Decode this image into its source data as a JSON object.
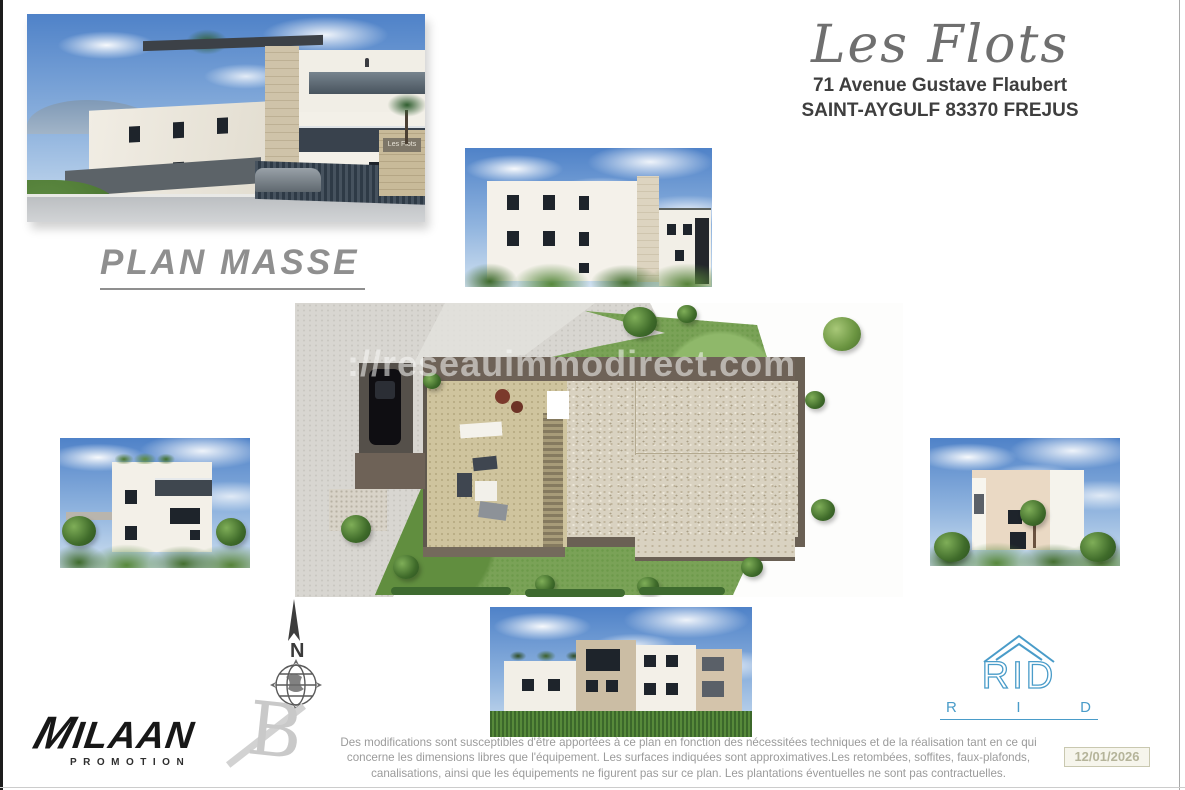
{
  "header": {
    "title": "Les Flots",
    "address_line1": "71 Avenue Gustave Flaubert",
    "address_line2": "SAINT-AYGULF 83370 FREJUS"
  },
  "plan_label": "PLAN MASSE",
  "site_plan": {
    "watermark": "://reseauimmodirect.com"
  },
  "compass": {
    "north_label": "N"
  },
  "logos": {
    "milaan": {
      "m": "M",
      "name": "ILAAN",
      "subtitle": "PROMOTION"
    },
    "architect": {
      "letter": "B"
    },
    "rid": {
      "house_letters": "RID",
      "r": "R",
      "i": "I",
      "d": "D"
    }
  },
  "entrance_sign": "Les Flots",
  "disclaimer": {
    "text": "Des modifications sont susceptibles d'être apportées à ce plan en fonction des nécessitées techniques et de la réalisation tant en ce qui concerne les dimensions libres que l'équipement.  Les surfaces indiquées sont approximatives.Les retombées, soffites, faux-plafonds, canalisations, ainsi que les équipements ne figurent pas sur ce plan. Les plantations éventuelles ne sont pas contractuelles."
  },
  "date_stamp": "12/01/2026",
  "colors": {
    "rid_blue": "#4a9cc9",
    "title_gray": "#6f6f6f",
    "plan_label_gray": "#8f8f8f",
    "disclaimer_gray": "#9b9b9b"
  }
}
